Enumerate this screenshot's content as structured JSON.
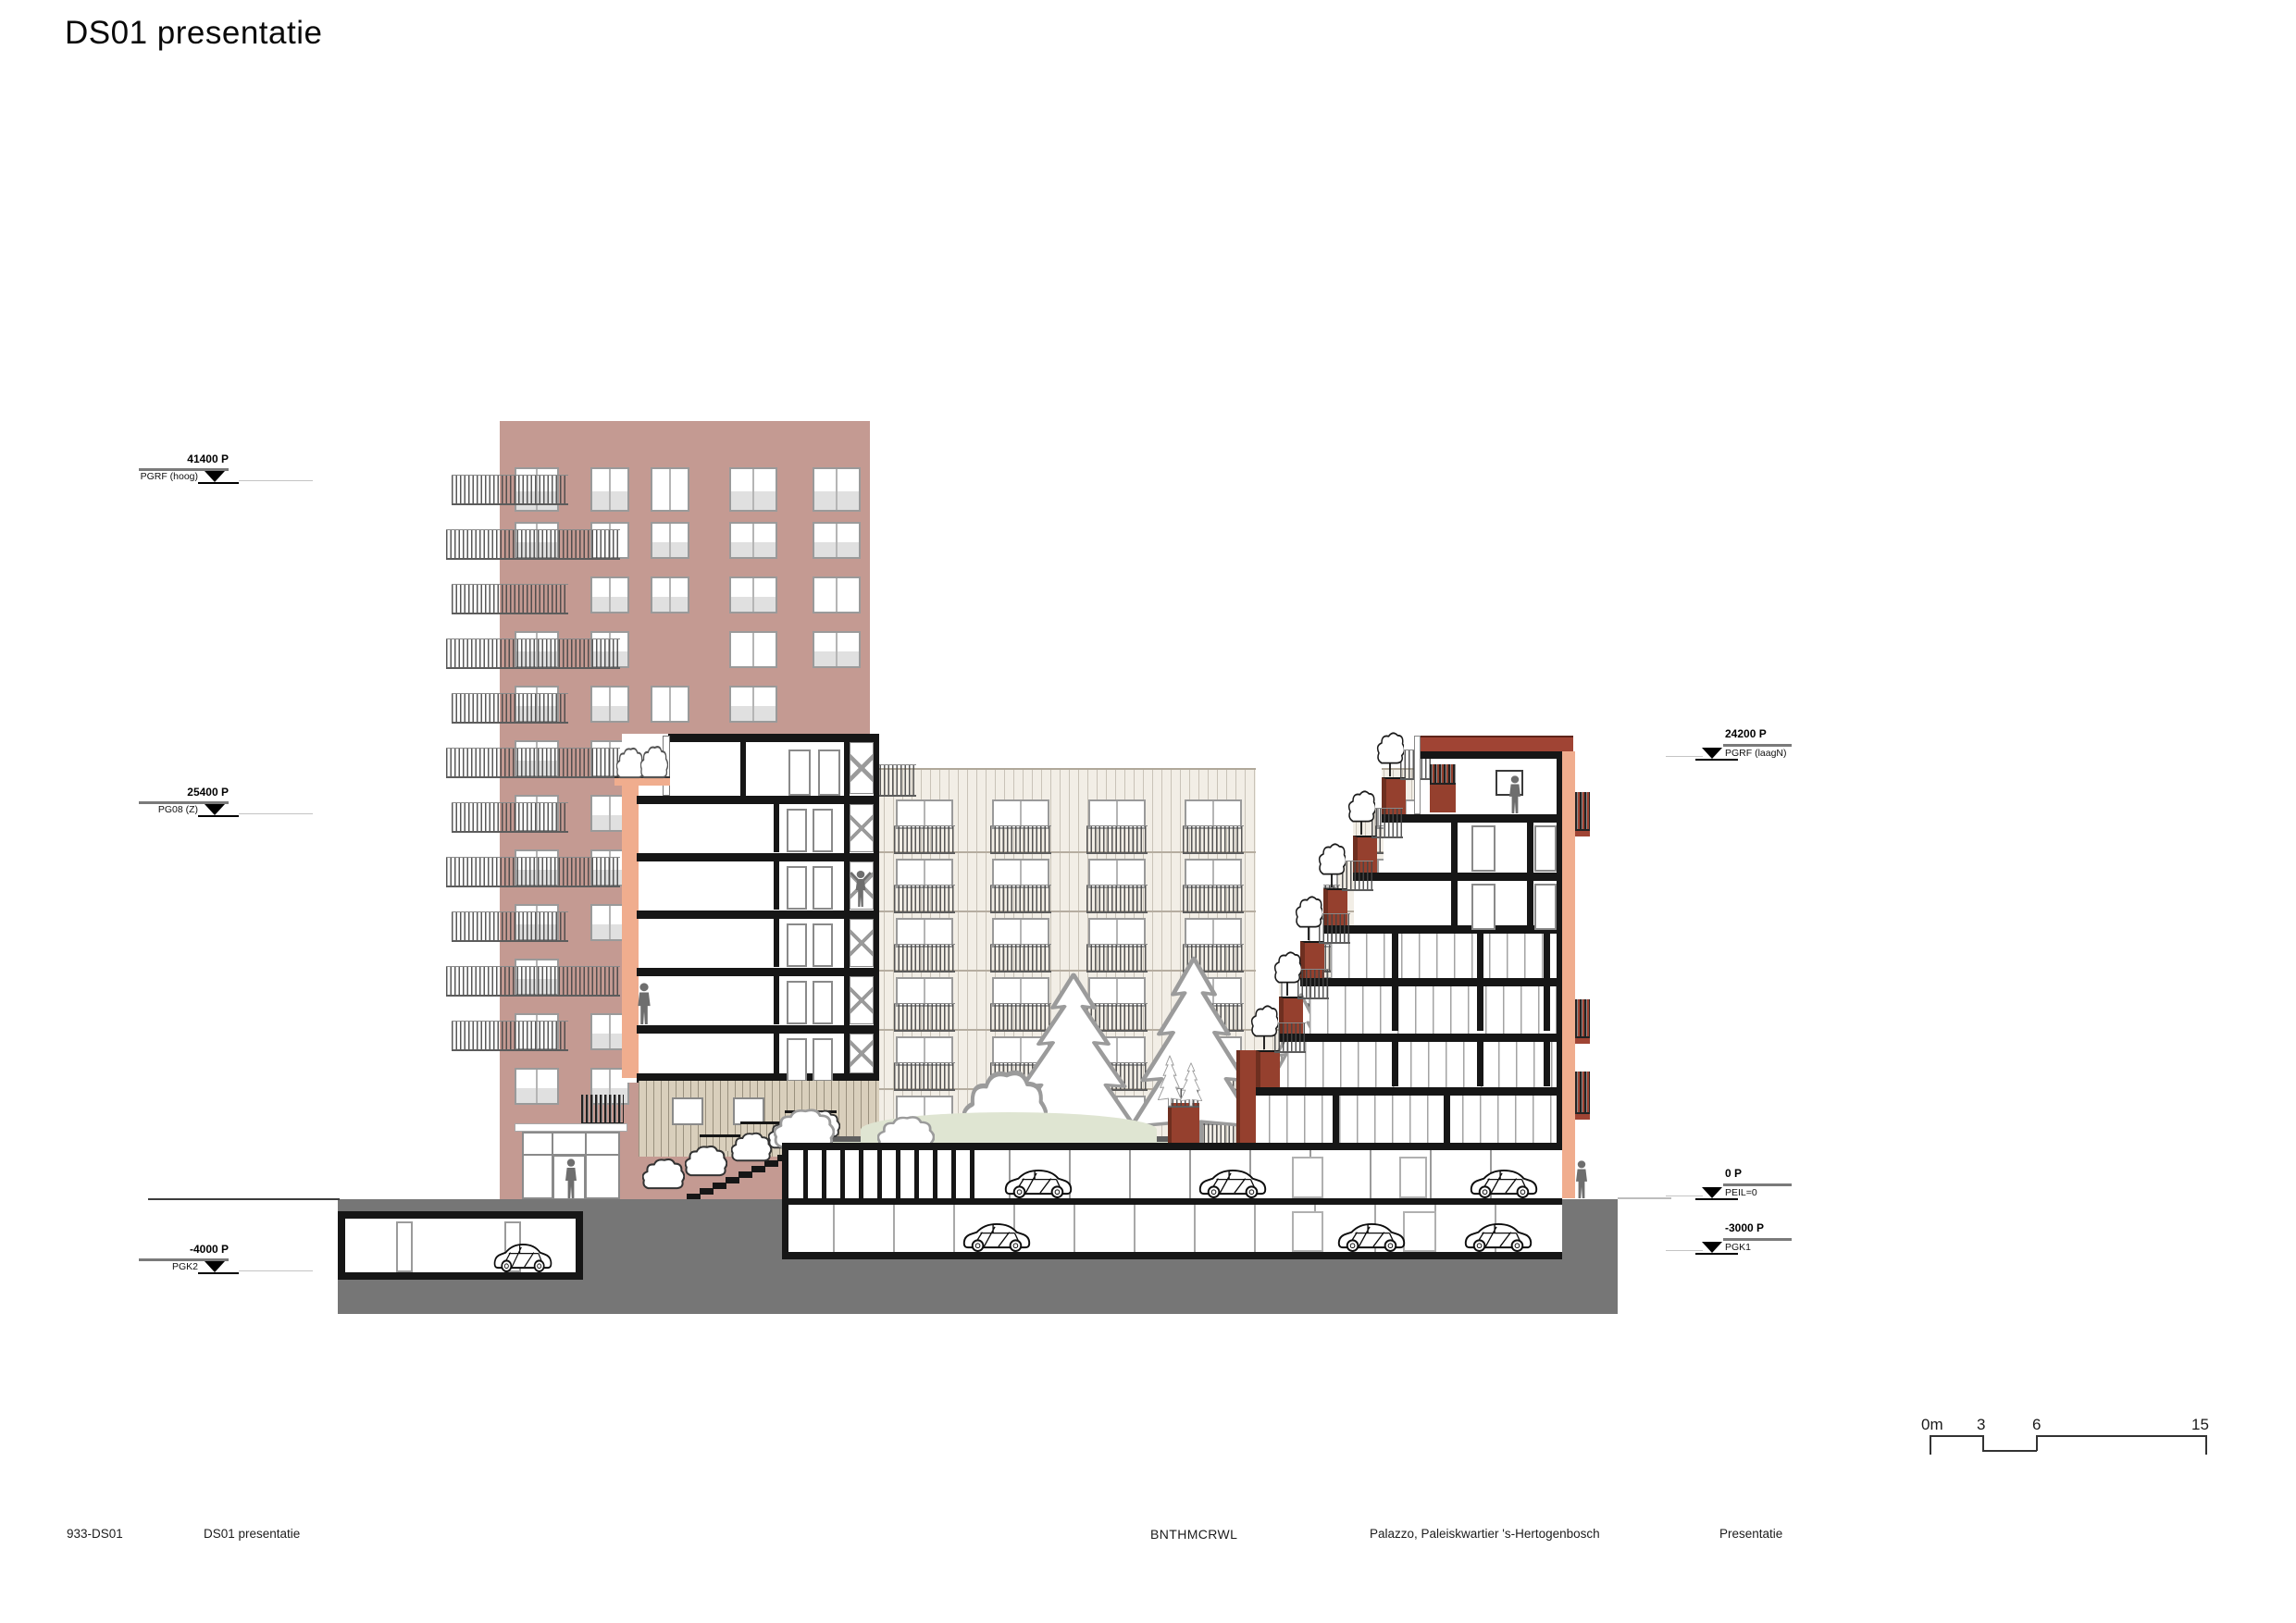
{
  "title": "DS01 presentatie",
  "levels": {
    "left": [
      {
        "value": "41400 P",
        "name": "PGRF (hoog)"
      },
      {
        "value": "25400 P",
        "name": "PG08 (Z)"
      },
      {
        "value": "-4000 P",
        "name": "PGK2"
      }
    ],
    "right": [
      {
        "value": "24200 P",
        "name": "PGRF (laagN)"
      },
      {
        "value": "0 P",
        "name": "PEIL=0"
      },
      {
        "value": "-3000 P",
        "name": "PGK1"
      }
    ]
  },
  "scalebar": {
    "labels": [
      "0m",
      "3",
      "6",
      "15"
    ]
  },
  "footer": {
    "drawing_number": "933-DS01",
    "drawing_title": "DS01 presentatie",
    "architect": "BNTHMCRWL",
    "project": "Palazzo, Paleiskwartier 's-Hertogenbosch",
    "phase": "Presentatie"
  },
  "colors": {
    "tower_pink": "#c49a92",
    "salmon": "#f0ad8e",
    "brick_red": "#95402e",
    "brick_dark": "#6e2f20",
    "roof_red": "#a04434",
    "facade_beige": "#f2eee6",
    "podium_beige": "#d9cfbc",
    "courtyard_green": "#dfe5d2",
    "ground_grey": "#767676",
    "walkway_grey": "#5f5f5f",
    "section_black": "#161616",
    "window_pane_grey": "#e0e0e0",
    "figure_grey": "#6e6e6e"
  }
}
